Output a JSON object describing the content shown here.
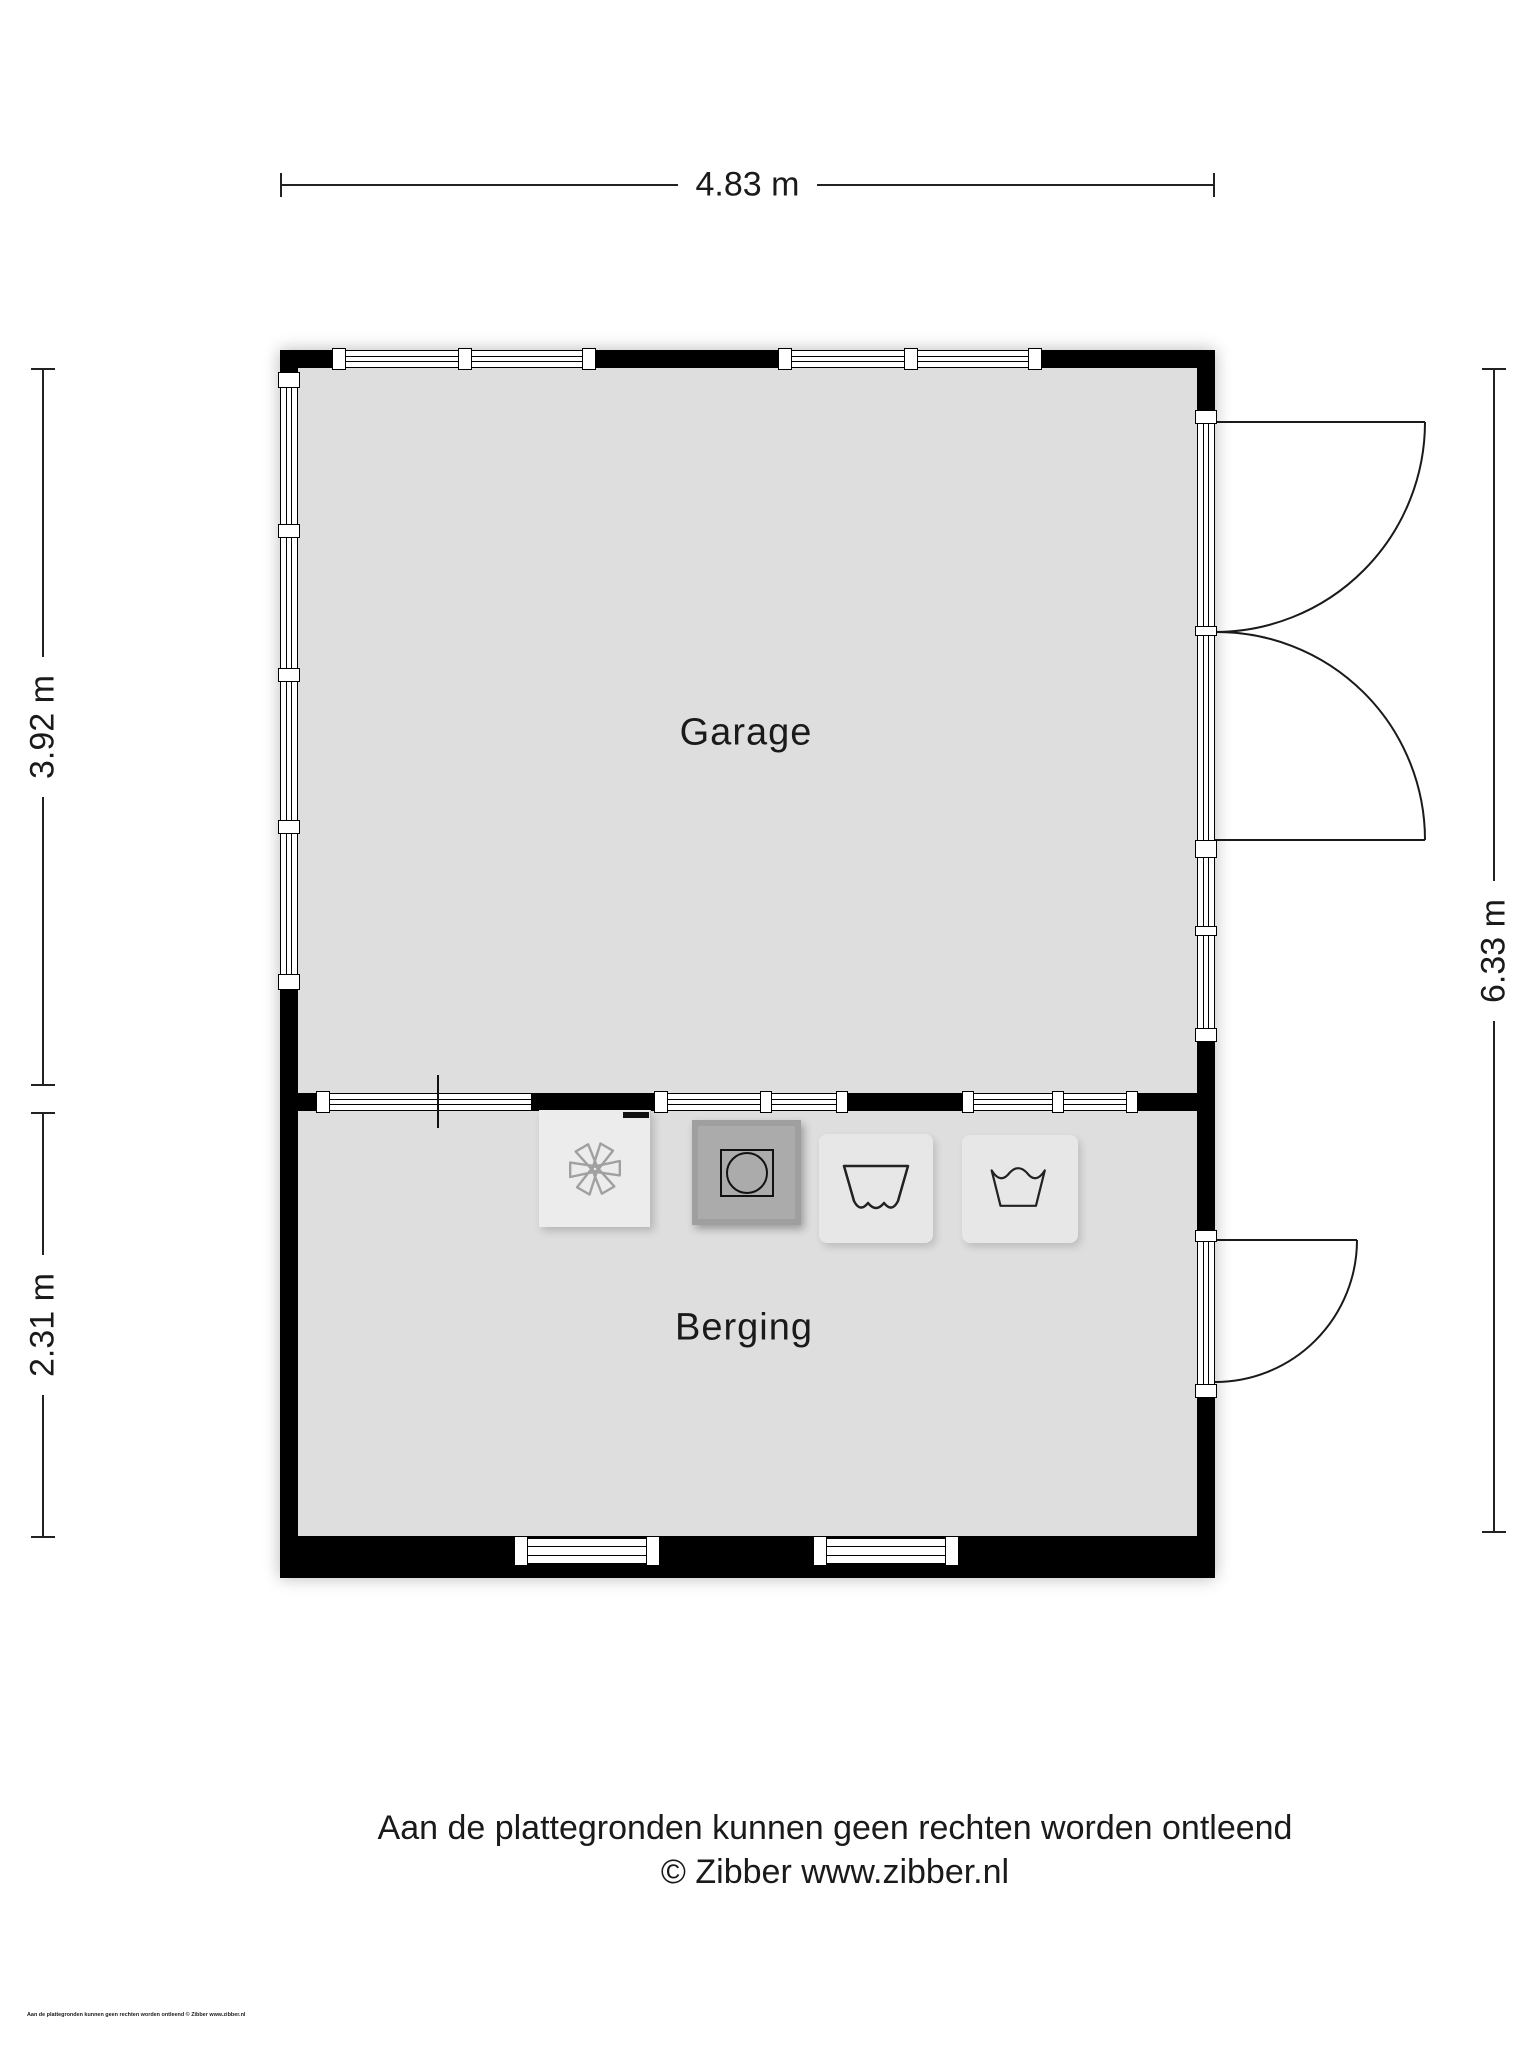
{
  "floorplan": {
    "dimensions": {
      "width_top": "4.83 m",
      "garage_height": "3.92 m",
      "berging_height": "2.31 m",
      "total_height": "6.33 m"
    },
    "rooms": [
      {
        "name": "Garage"
      },
      {
        "name": "Berging"
      }
    ],
    "appliances": [
      {
        "icon": "fan-icon"
      },
      {
        "icon": "washing-machine-icon"
      },
      {
        "icon": "laundry-dry-symbol-icon"
      },
      {
        "icon": "laundry-wash-symbol-icon"
      }
    ],
    "colors": {
      "floor": "#dedede",
      "wall": "#000000",
      "appliance_dark": "#9f9f9f",
      "appliance_light": "#ececec",
      "fan_stroke": "#a0a0a0"
    }
  },
  "footer": {
    "disclaimer": "Aan de plattegronden kunnen geen rechten worden ontleend",
    "copyright": "© Zibber www.zibber.nl",
    "small_print": "Aan de plattegronden kunnen geen rechten worden ontleend © Zibber www.zibber.nl"
  }
}
